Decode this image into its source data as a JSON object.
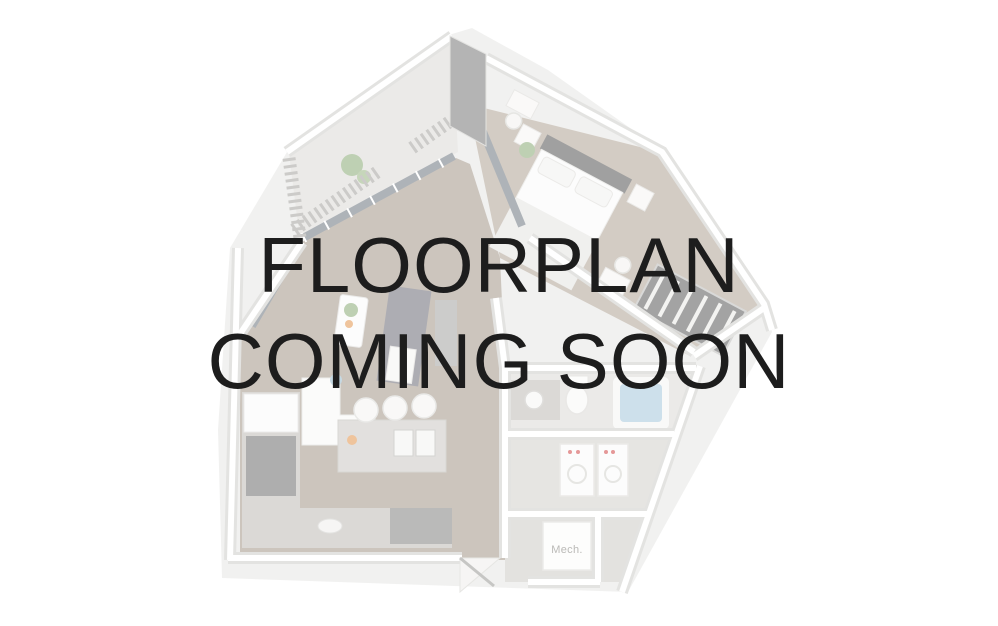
{
  "page": {
    "background_color": "#ffffff"
  },
  "overlay": {
    "line1": "FLOORPLAN",
    "line2": "COMING SOON",
    "text_color": "#1d1d1d"
  },
  "floorplan": {
    "description": "faded 3d apartment floorplan rendering",
    "mech_room_label": "Mech.",
    "fade_opacity": "0.5",
    "palette": {
      "slab": "#e4e4e2",
      "wall_edge": "#c9c8c4",
      "wall_face": "#ffffff",
      "wood_floor": "#9a8c7e",
      "bedroom_floor": "#a89a8a",
      "tile_floor": "#d8d6d2",
      "glass": "#5f6a74",
      "dark_wall": "#6b6b6b",
      "closet_dark": "#4a4a4a",
      "rug_dark": "#5e5e6a",
      "headboard": "#444444",
      "counter_granite": "#b8b4ae",
      "appliance_dark": "#5f5f5f",
      "tub_water": "#9dc2d8",
      "plant_green": "#7fa36a",
      "accent_orange": "#e08a3c",
      "appliance_red_dot": "#cc3333",
      "pillow_blue": "#8fb4c8",
      "mech_label_color": "#77756f"
    }
  }
}
